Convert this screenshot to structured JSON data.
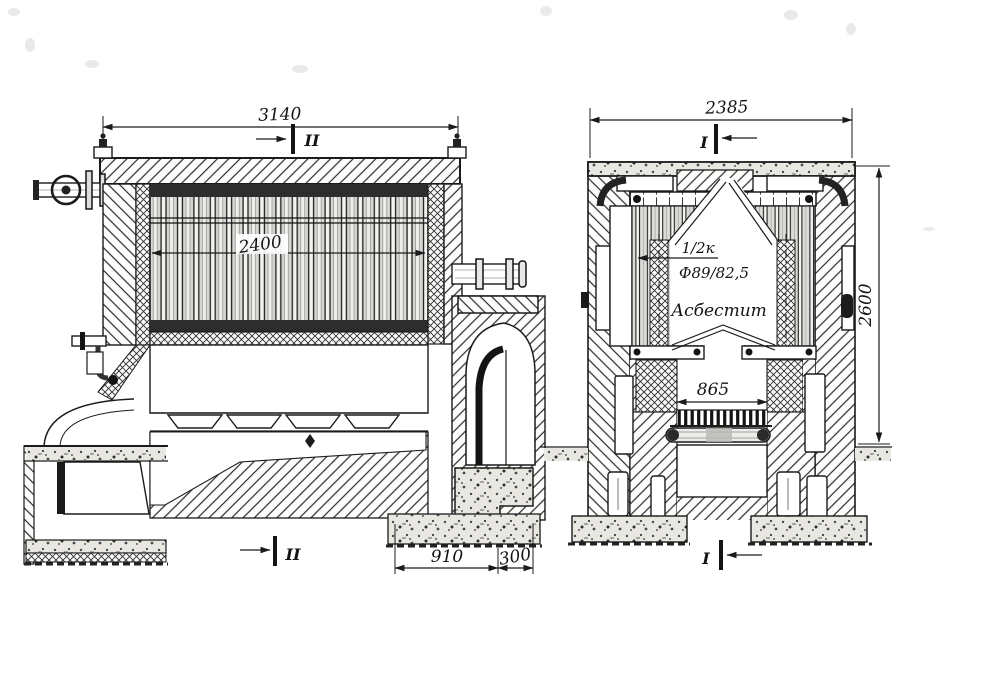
{
  "page": {
    "background_color": "#ffffff",
    "ink_color": "#1b1b1b",
    "description": "Scanned technical drawing of a sectional water-tube boiler: longitudinal section (left) and cross section (right)"
  },
  "left_view": {
    "view_name": "longitudinal-section",
    "overall_width_dim": "3140",
    "tube_bank_dim": "2400",
    "section_marker_top": "II",
    "section_marker_bottom": "II",
    "foundation_dim_main": "910",
    "foundation_dim_ledge": "300"
  },
  "right_view": {
    "view_name": "cross-section",
    "overall_width_dim": "2385",
    "overall_height_dim": "2600",
    "section_marker_top": "I",
    "section_marker_bottom": "I",
    "grate_width_dim": "865",
    "tube_count_note": "1/2к",
    "tube_diameter_note": "Ф89/82,5",
    "insulation_note": "Асбестит"
  }
}
